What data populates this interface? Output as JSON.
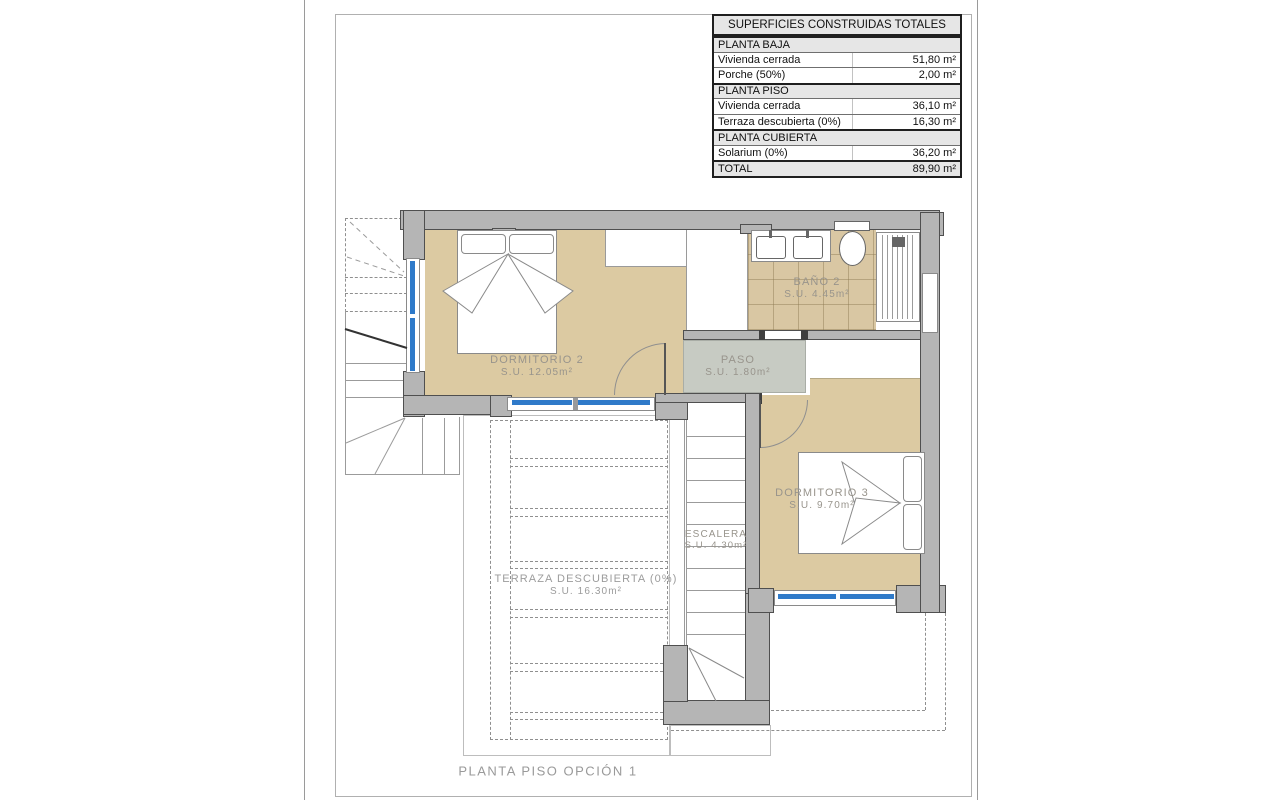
{
  "page": {
    "bottom_title": "PLANTA PISO OPCIÓN 1"
  },
  "summary_table": {
    "title": "SUPERFICIES CONSTRUIDAS TOTALES",
    "rows": [
      {
        "kind": "section",
        "label": "PLANTA BAJA",
        "value": ""
      },
      {
        "kind": "data",
        "label": "Vivienda cerrada",
        "value": "51,80 m²"
      },
      {
        "kind": "data",
        "label": "Porche (50%)",
        "value": "2,00 m²"
      },
      {
        "kind": "section",
        "label": "PLANTA PISO",
        "value": ""
      },
      {
        "kind": "data",
        "label": "Vivienda cerrada",
        "value": "36,10 m²"
      },
      {
        "kind": "data",
        "label": "Terraza descubierta (0%)",
        "value": "16,30 m²"
      },
      {
        "kind": "section",
        "label": "PLANTA CUBIERTA",
        "value": ""
      },
      {
        "kind": "data",
        "label": "Solarium (0%)",
        "value": "36,20 m²"
      },
      {
        "kind": "total",
        "label": "TOTAL",
        "value": "89,90 m²"
      }
    ]
  },
  "rooms": {
    "dormitorio2": {
      "name": "DORMITORIO 2",
      "area": "S.U. 12.05m²"
    },
    "bano2": {
      "name": "BAÑO 2",
      "area": "S.U. 4.45m²"
    },
    "paso": {
      "name": "PASO",
      "area": "S.U. 1.80m²"
    },
    "dormitorio3": {
      "name": "DORMITORIO 3",
      "area": "S.U. 9.70m²"
    },
    "escalera": {
      "name": "ESCALERA",
      "area": "S.U. 4.30m²"
    },
    "terraza": {
      "name": "TERRAZA DESCUBIERTA (0%)",
      "area": "S.U. 16.30m²"
    }
  },
  "colors": {
    "floor_beige": "#dccaa2",
    "wall_gray": "#b5b5b5",
    "paso_gray": "#c7cbc3",
    "window_blue": "#2f7ac9",
    "label_gray": "#98948c"
  }
}
